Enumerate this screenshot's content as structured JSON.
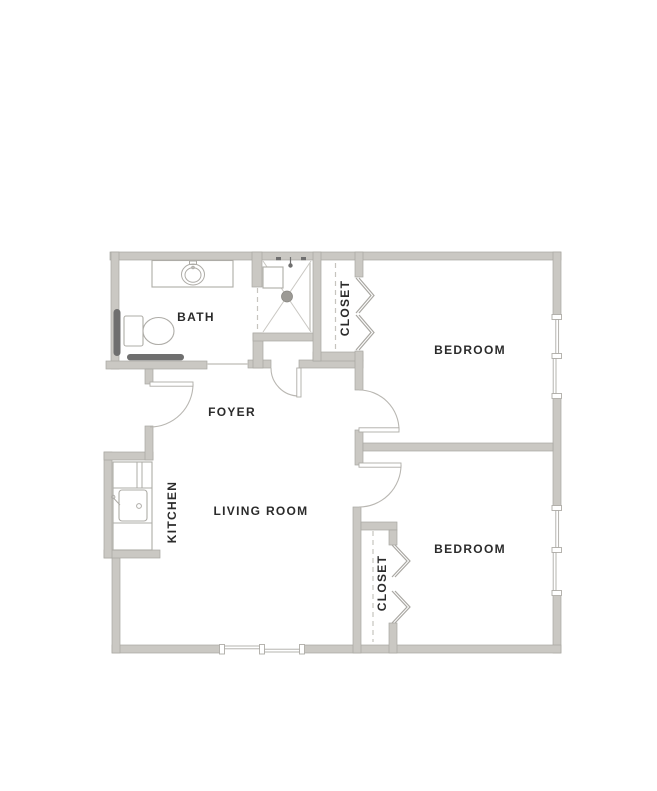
{
  "colors": {
    "background": "#ffffff",
    "wall": "#cac8c3",
    "wall_edge": "#a9a7a2",
    "door_arc": "#b9b7b2",
    "fixture_line": "#aeaca7",
    "dashed_line": "#c6c4bf",
    "dark_fixture": "#6f6f6f",
    "shower_line": "#c9c7c2",
    "drain_fill": "#9c9a95",
    "text": "#2b2b2b"
  },
  "rooms": [
    {
      "id": "bath",
      "label": "BATH"
    },
    {
      "id": "closet-1",
      "label": "CLOSET"
    },
    {
      "id": "bedroom-1",
      "label": "BEDROOM"
    },
    {
      "id": "foyer",
      "label": "FOYER"
    },
    {
      "id": "kitchen",
      "label": "KITCHEN"
    },
    {
      "id": "living-room",
      "label": "LIVING ROOM"
    },
    {
      "id": "closet-2",
      "label": "CLOSET"
    },
    {
      "id": "bedroom-2",
      "label": "BEDROOM"
    }
  ]
}
